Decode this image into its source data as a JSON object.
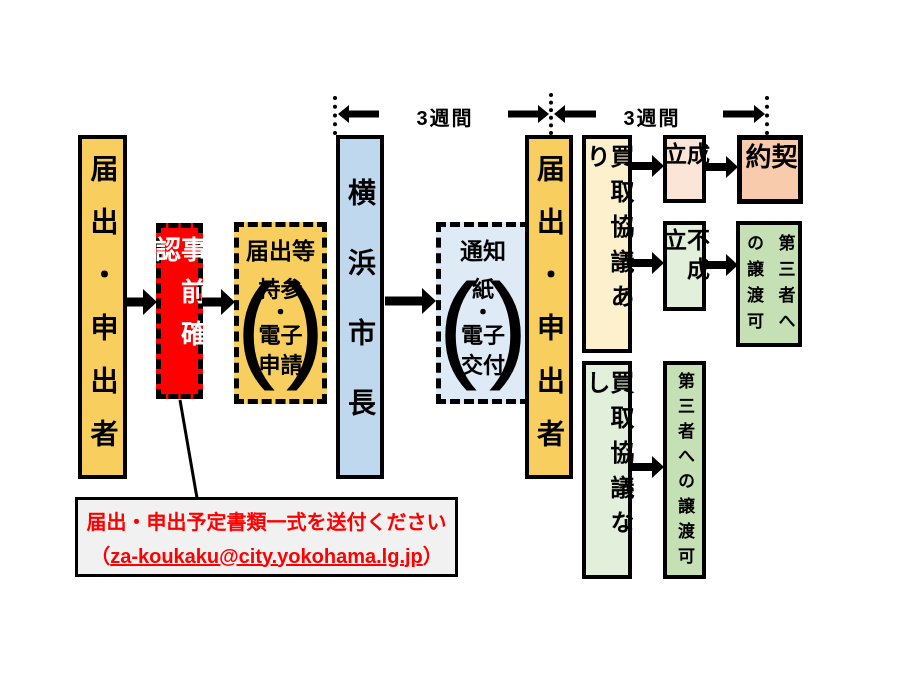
{
  "timeline": {
    "span1_label": "3週間",
    "span2_label": "3週間"
  },
  "flow": {
    "applicant_left": "届出・申出者",
    "pre_check": "事前確認",
    "submission": {
      "title": "届出等",
      "lines": [
        "持参",
        "・",
        "電子",
        "申請"
      ],
      "bracket_open": "(",
      "bracket_close": ")"
    },
    "mayor": "横浜市長",
    "notice": {
      "title": "通知",
      "lines": [
        "紙",
        "・",
        "電子",
        "交付"
      ],
      "bracket_open": "(",
      "bracket_close": ")"
    },
    "applicant_right": "届出・申出者",
    "negotiation_yes": "買取協議あり",
    "established": "成立",
    "contract": "契約",
    "not_established": "不成立",
    "transfer_allowed_top": "第三者へ\nの譲渡可",
    "negotiation_no": "買取協議なし",
    "transfer_allowed_bottom": "第三者への譲渡可"
  },
  "note": {
    "line1": "届出・申出予定書類一式を送付ください",
    "paren_open": "（",
    "email": "za-koukaku@city.yokohama.lg.jp",
    "paren_close": "）"
  },
  "colors": {
    "applicant_yellow": "#F8CE5E",
    "pre_check_red": "#FF0000",
    "mayor_blue": "#BFD8EE",
    "notice_blue": "#DEEAF6",
    "negotiation_yes_cream": "#FCF0CD",
    "established_peach": "#FBE5D6",
    "contract_orange": "#F8CBAD",
    "not_established_green": "#E2EFDA",
    "transfer_green": "#C5E0B4",
    "note_gray": "#F1F1F1",
    "note_text_red": "#FF0000",
    "line_black": "#000000"
  }
}
